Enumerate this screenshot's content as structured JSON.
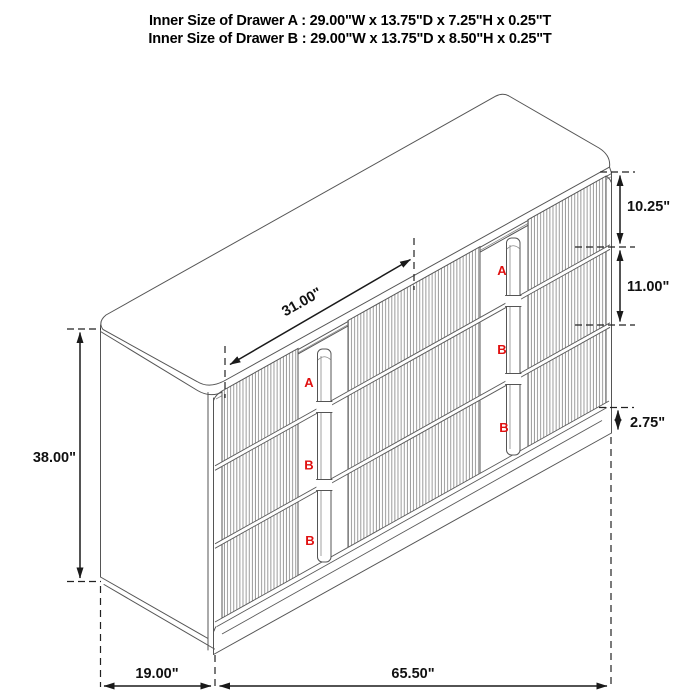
{
  "title": {
    "line1": "Inner Size of Drawer A : 29.00\"W x 13.75\"D x 7.25\"H x 0.25\"T",
    "line2": "Inner Size of Drawer B : 29.00\"W x 13.75\"D x 8.50\"H x 0.25\"T"
  },
  "dimensions": {
    "top_span": "31.00\"",
    "overall_height": "38.00\"",
    "drawer_a_front_height": "10.25\"",
    "drawer_b_front_height": "11.00\"",
    "base_height": "2.75\"",
    "overall_depth": "19.00\"",
    "overall_width": "65.50\""
  },
  "drawer_marks": {
    "left_column": [
      "A",
      "B",
      "B"
    ],
    "right_column": [
      "A",
      "B",
      "B"
    ]
  },
  "colors": {
    "line": "#555555",
    "dimension_line": "#1a1a1a",
    "drawer_mark": "#e01010",
    "background": "#ffffff"
  }
}
